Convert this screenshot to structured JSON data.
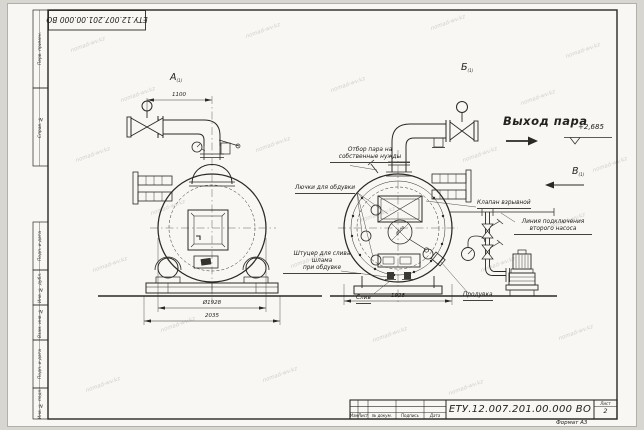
{
  "sheet": {
    "doc_number": "ЕТУ.12.007.201.00.000 ВО",
    "doc_number_top": "ЕТУ.12.007.201.00.000 ВО",
    "format_label": "Формат А3",
    "sheet_label": "Лист",
    "sheet_number": "2",
    "revision_columns": [
      "Изм",
      "Лист",
      "№ докум.",
      "Подпись",
      "Дата"
    ],
    "margin_fields": [
      "Перв. примен.",
      "Справ. №",
      "Подп. и дата",
      "Инв. № дубл.",
      "Взам. инв. №",
      "Подп. и дата",
      "Инв. № подл."
    ]
  },
  "views": {
    "a": "А",
    "b": "Б",
    "v": "В",
    "sub": "(1)"
  },
  "annotations": {
    "steam_outlet": "Выход пара",
    "elevation_mark": "+2,685",
    "own_needs_1": "Отбор пара на",
    "own_needs_2": "собственные нужды",
    "blow_hatches": "Лючки для обдувки",
    "explosion_valve": "Клапан взрывной",
    "second_pump_1": "Линия подключения",
    "second_pump_2": "второго насоса",
    "sludge_1": "Штуцер для слива шлама",
    "sludge_2": "при обдувке",
    "drain": "Слив",
    "blowdown": "Продувка"
  },
  "dimensions": {
    "pipe_offset": "1100",
    "shell_diameter": "Ø1928",
    "overall_width": "2035",
    "rear_width": "1928",
    "furnace_diameter": "Ø500"
  },
  "watermark": {
    "text": "nomad-wv.kz"
  }
}
